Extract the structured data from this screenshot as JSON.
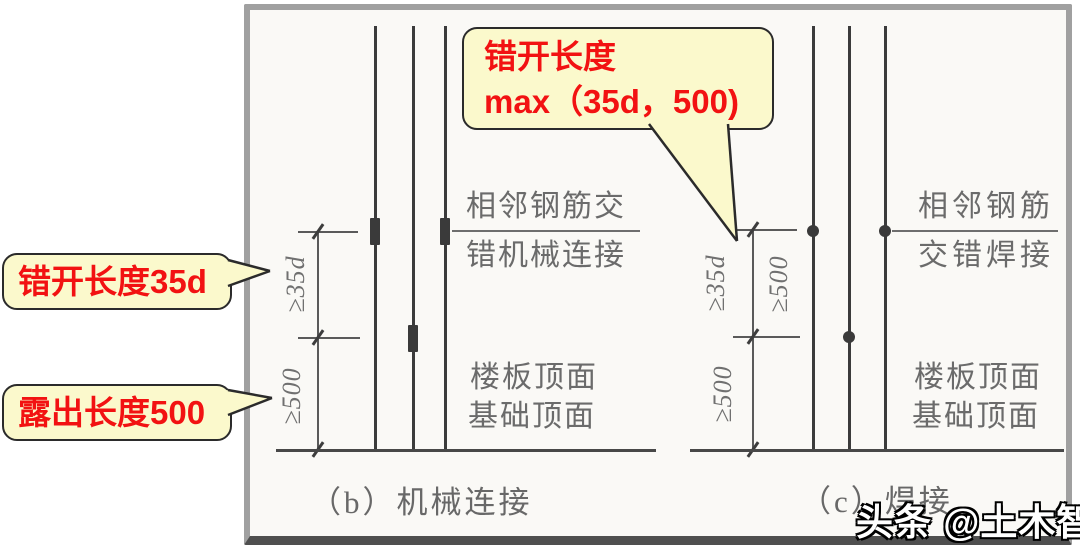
{
  "panel_b": {
    "caption": "（b）机械连接",
    "joint_line1": "相邻钢筋交",
    "joint_line2": "错机械连接",
    "surface_line1": "楼板顶面",
    "surface_line2": "基础顶面",
    "dim_stagger": "≥35d",
    "dim_exposed": "≥500"
  },
  "panel_c": {
    "caption": "（c）焊接",
    "joint_line1": "相邻钢筋",
    "joint_line2": "交错焊接",
    "surface_line1": "楼板顶面",
    "surface_line2": "基础顶面",
    "dim_stagger": "≥35d",
    "dim_stagger_alt": "≥500",
    "dim_exposed": "≥500"
  },
  "callouts": {
    "top_line1": "错开长度",
    "top_line2": "max（35d，500)",
    "stagger": "错开长度35d",
    "exposed": "露出长度500"
  },
  "watermark": "头条 @土木智库",
  "colors": {
    "callout_bg": "#FBF9CC",
    "callout_border": "#2b2b2b",
    "callout_text": "#F21212",
    "line_color": "#3b3b3b",
    "dim_color": "#5a5a5a",
    "label_color": "#6b6b6b"
  }
}
